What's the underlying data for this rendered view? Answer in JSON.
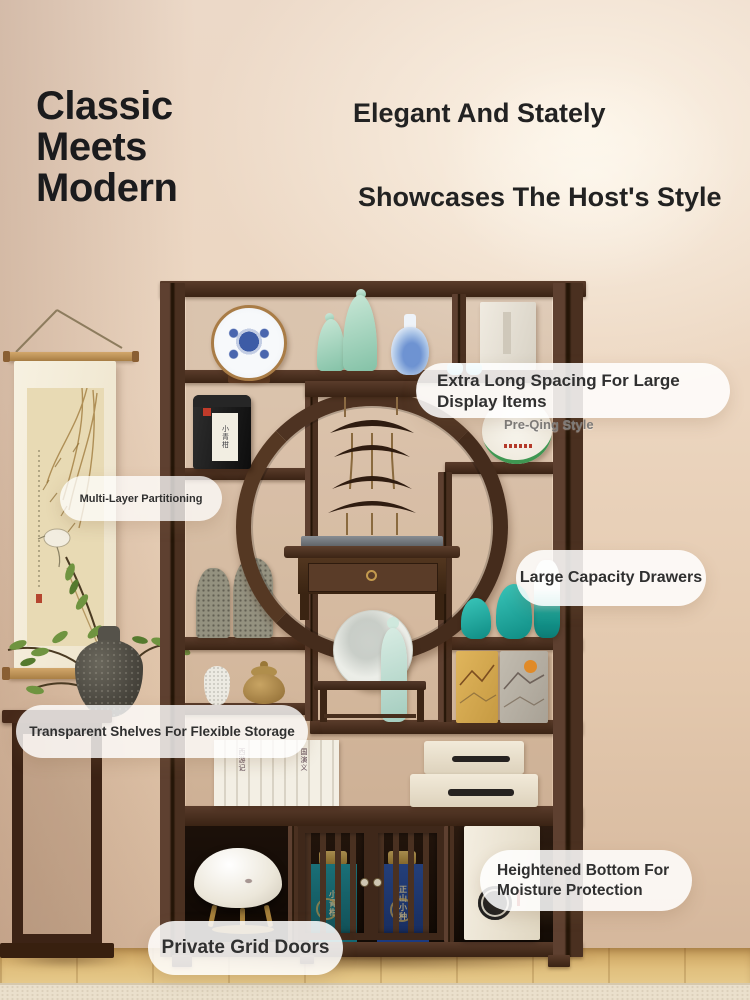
{
  "headline": {
    "lines": [
      "Classic",
      "Meets",
      "Modern"
    ]
  },
  "taglines": {
    "first": "Elegant And Stately",
    "second": "Showcases The Host's Style"
  },
  "callouts": {
    "extra_long": "Extra Long Spacing For Large Display Items",
    "multi_layer": "Multi-Layer Partitioning",
    "drawers": "Large Capacity Drawers",
    "transparent": "Transparent Shelves For Flexible Storage",
    "heightened": "Heightened Bottom For Moisture Protection",
    "doors": "Private Grid Doors"
  },
  "photo": {
    "overlay_label": "Pre-Qing Style",
    "products": {
      "tea_caddy_label": "小青柑",
      "grid_teal_box_label": "小青柑",
      "grid_blue_box_label": "正山小种",
      "books_left_label": "西游记",
      "books_right_label": "国演义"
    }
  },
  "colors": {
    "headline_text": "#1b1b1d",
    "wood_dark": "#3f2718",
    "accent_teal": "#17a096",
    "wall_beige": "#ead6c2",
    "floor_wood": "#e0bf7d",
    "pill_bg": "#ffffff",
    "pill_text": "#303030"
  }
}
